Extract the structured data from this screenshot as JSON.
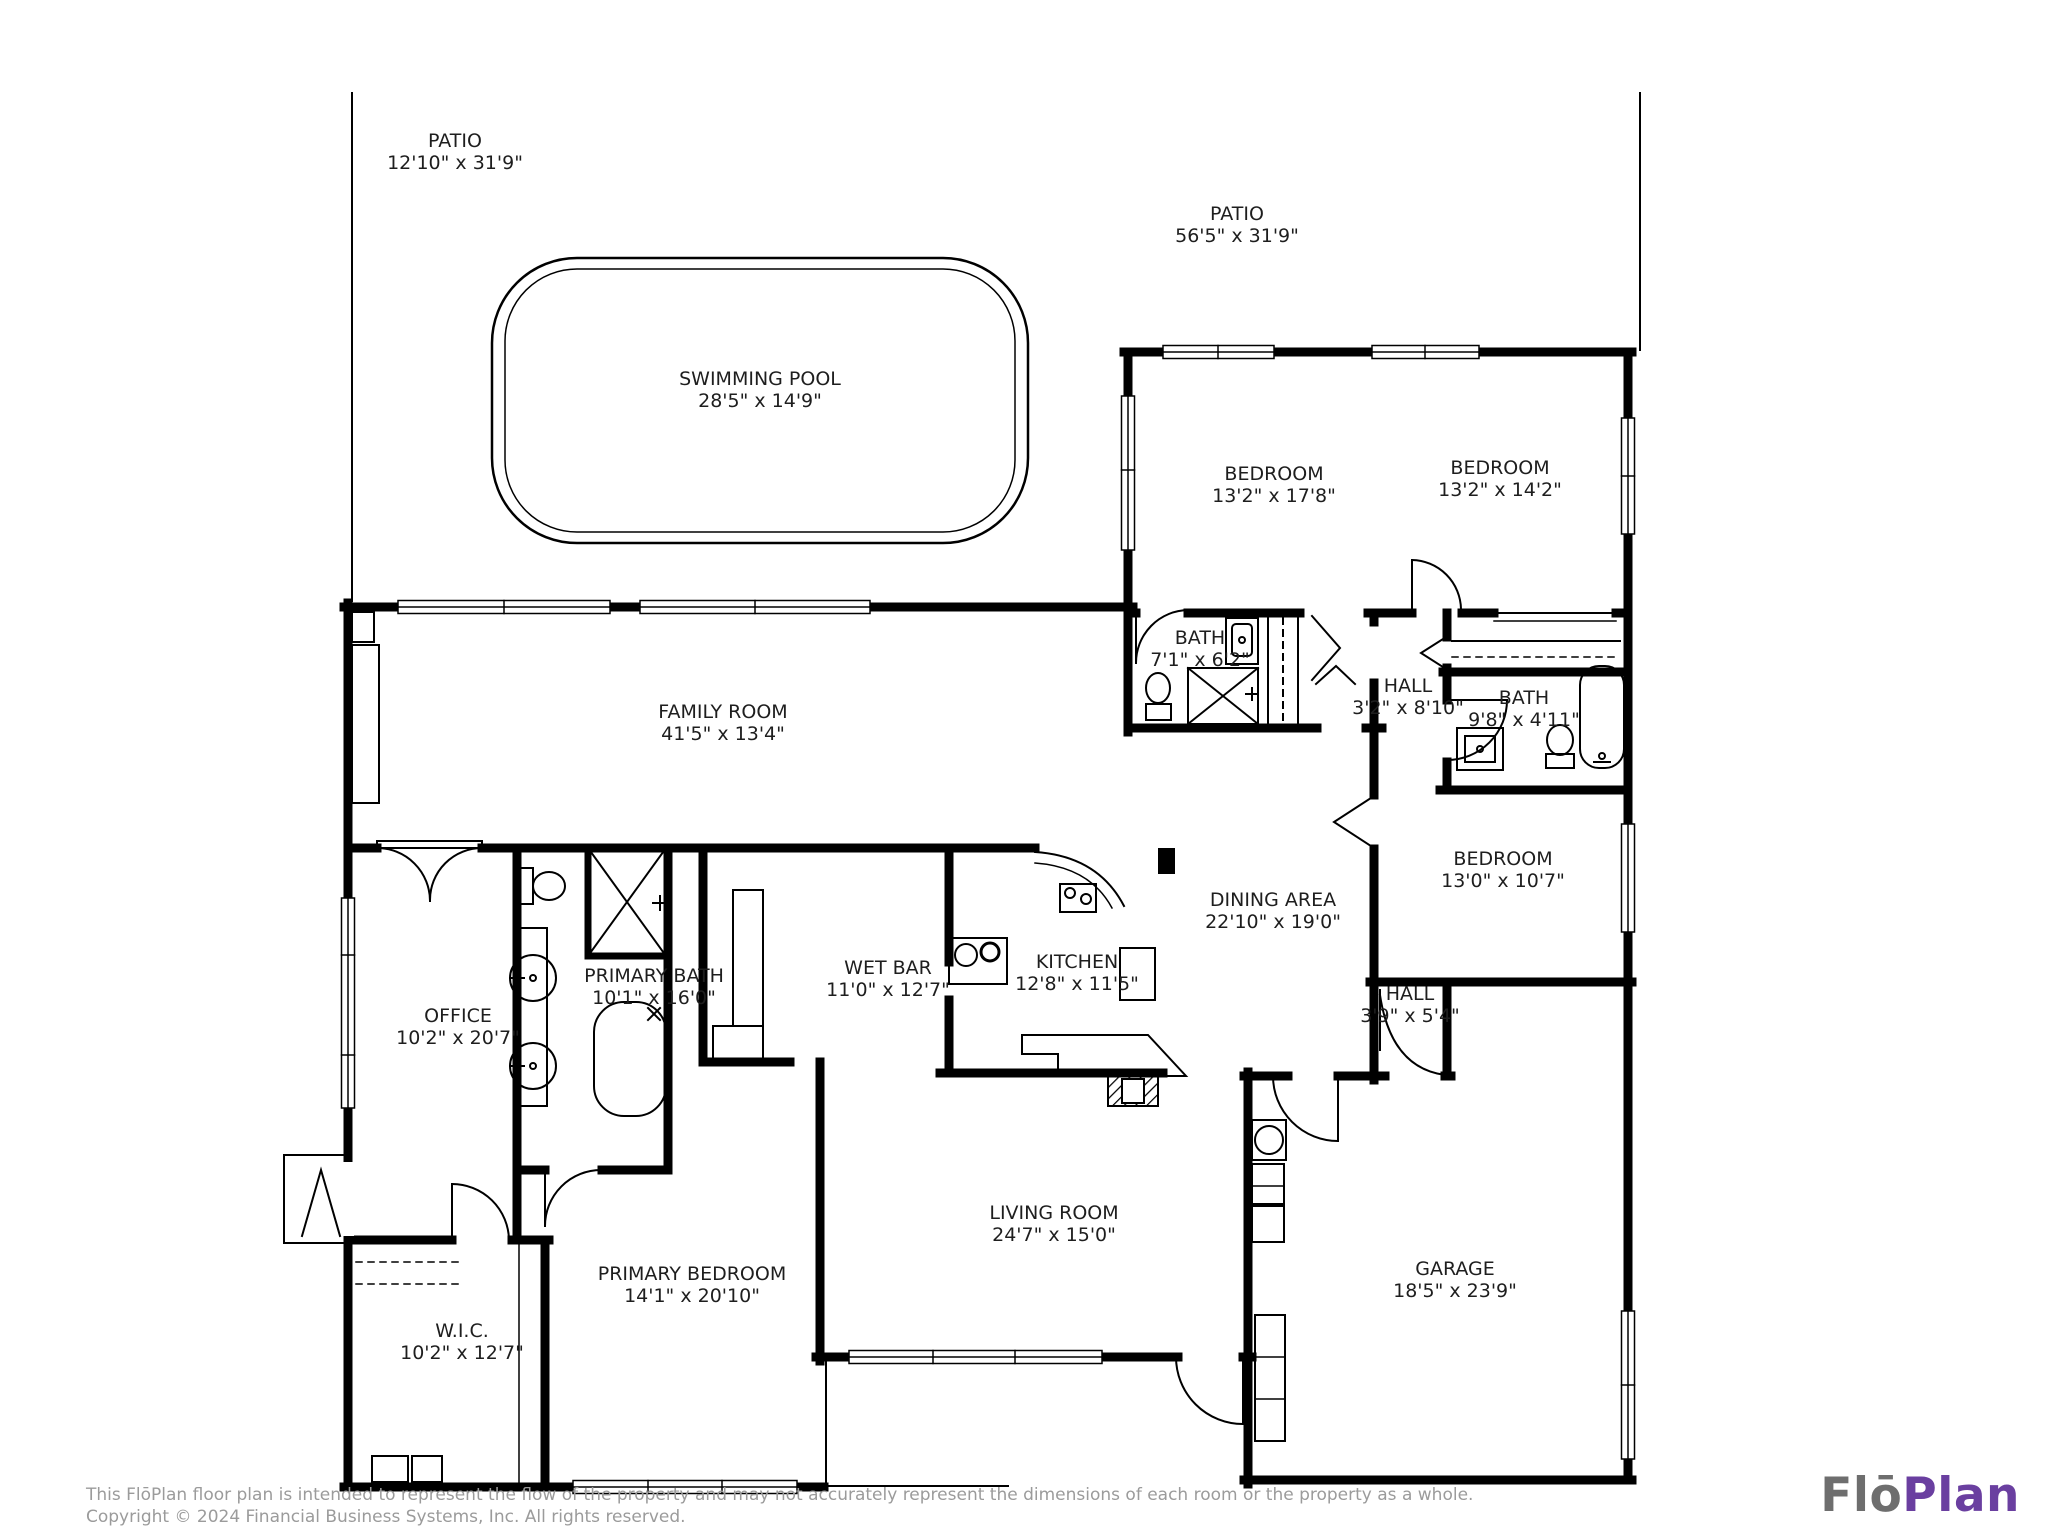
{
  "plan": {
    "rooms": [
      {
        "id": "patio-left",
        "name": "PATIO",
        "dims": "12'10\" x 31'9\""
      },
      {
        "id": "patio-right",
        "name": "PATIO",
        "dims": "56'5\" x 31'9\""
      },
      {
        "id": "swimming-pool",
        "name": "SWIMMING POOL",
        "dims": "28'5\" x 14'9\""
      },
      {
        "id": "bedroom-1",
        "name": "BEDROOM",
        "dims": "13'2\" x 17'8\""
      },
      {
        "id": "bedroom-2",
        "name": "BEDROOM",
        "dims": "13'2\" x 14'2\""
      },
      {
        "id": "bath-1",
        "name": "BATH",
        "dims": "7'1\" x 6'2\""
      },
      {
        "id": "hall-1",
        "name": "HALL",
        "dims": "3'2\" x 8'10\""
      },
      {
        "id": "bath-2",
        "name": "BATH",
        "dims": "9'8\" x 4'11\""
      },
      {
        "id": "family-room",
        "name": "FAMILY ROOM",
        "dims": "41'5\" x 13'4\""
      },
      {
        "id": "bedroom-3",
        "name": "BEDROOM",
        "dims": "13'0\" x 10'7\""
      },
      {
        "id": "dining-area",
        "name": "DINING AREA",
        "dims": "22'10\" x 19'0\""
      },
      {
        "id": "wet-bar",
        "name": "WET BAR",
        "dims": "11'0\" x 12'7\""
      },
      {
        "id": "kitchen",
        "name": "KITCHEN",
        "dims": "12'8\" x 11'5\""
      },
      {
        "id": "primary-bath",
        "name": "PRIMARY BATH",
        "dims": "10'1\" x 16'0\""
      },
      {
        "id": "office",
        "name": "OFFICE",
        "dims": "10'2\" x 20'7\""
      },
      {
        "id": "hall-2",
        "name": "HALL",
        "dims": "3'9\" x 5'4\""
      },
      {
        "id": "living-room",
        "name": "LIVING ROOM",
        "dims": "24'7\" x 15'0\""
      },
      {
        "id": "primary-bedroom",
        "name": "PRIMARY BEDROOM",
        "dims": "14'1\" x 20'10\""
      },
      {
        "id": "wic",
        "name": "W.I.C.",
        "dims": "10'2\" x 12'7\""
      },
      {
        "id": "garage",
        "name": "GARAGE",
        "dims": "18'5\" x 23'9\""
      }
    ]
  },
  "footer": {
    "disclaimer": "This FlōPlan floor plan is intended to represent the flow of the property and may not accurately represent the dimensions of each room or the property as a whole.",
    "copyright": "Copyright © 2024 Financial Business Systems, Inc. All rights reserved."
  },
  "logo": {
    "part1": "Flō",
    "part2": "Plan",
    "part1_color": "#6e6e6e",
    "part2_color": "#6a3fa0"
  }
}
